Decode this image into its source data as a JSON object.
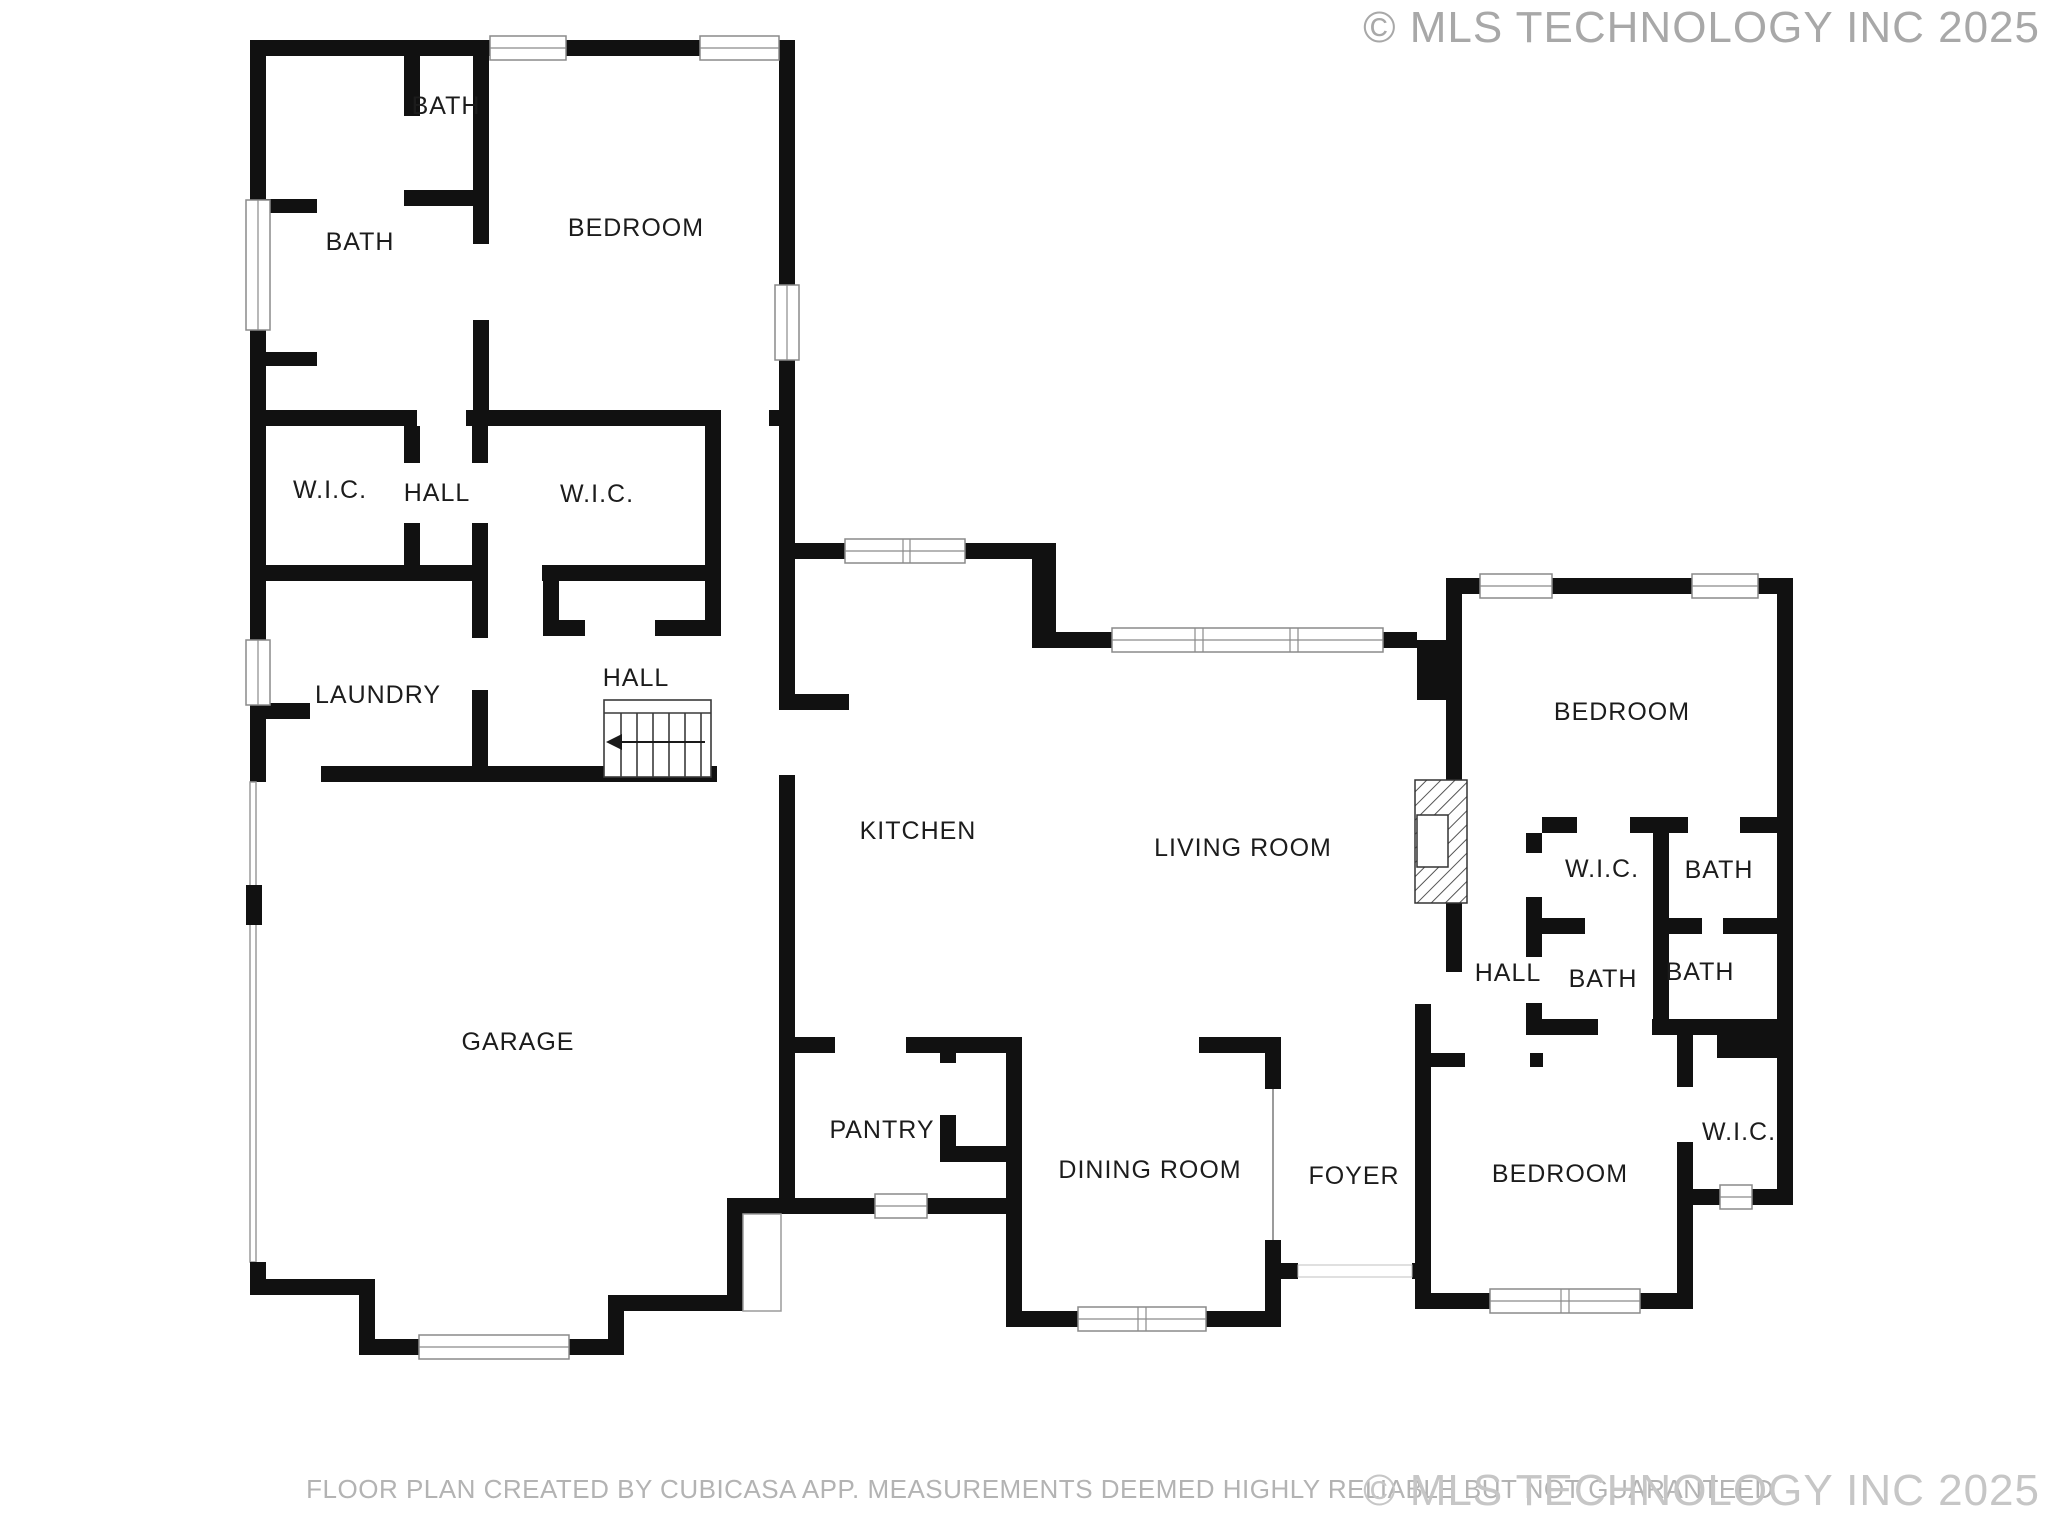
{
  "floor_plan": {
    "disclaimer": "FLOOR PLAN CREATED BY CUBICASA APP. MEASUREMENTS DEEMED HIGHLY RELIABLE BUT NOT GUARANTEED",
    "watermark_top_right": "© MLS TECHNOLOGY INC 2025",
    "watermark_bottom_right": "© MLS TECHNOLOGY INC 2025",
    "rooms": [
      {
        "id": "bath-small-top-left",
        "label": "BATH"
      },
      {
        "id": "bath-large-top-left",
        "label": "BATH"
      },
      {
        "id": "bedroom-top-left",
        "label": "BEDROOM"
      },
      {
        "id": "wic-left",
        "label": "W.I.C."
      },
      {
        "id": "hall-left",
        "label": "HALL"
      },
      {
        "id": "wic-middle",
        "label": "W.I.C."
      },
      {
        "id": "laundry",
        "label": "LAUNDRY"
      },
      {
        "id": "hall-stairs",
        "label": "HALL"
      },
      {
        "id": "garage",
        "label": "GARAGE"
      },
      {
        "id": "kitchen",
        "label": "KITCHEN"
      },
      {
        "id": "living-room",
        "label": "LIVING ROOM"
      },
      {
        "id": "pantry",
        "label": "PANTRY"
      },
      {
        "id": "dining-room",
        "label": "DINING ROOM"
      },
      {
        "id": "foyer",
        "label": "FOYER"
      },
      {
        "id": "bedroom-right",
        "label": "BEDROOM"
      },
      {
        "id": "wic-right-wing",
        "label": "W.I.C."
      },
      {
        "id": "bath-right-top",
        "label": "BATH"
      },
      {
        "id": "hall-right-wing",
        "label": "HALL"
      },
      {
        "id": "bath-right-middle",
        "label": "BATH"
      },
      {
        "id": "bath-right-far",
        "label": "BATH"
      },
      {
        "id": "bedroom-bottom-right",
        "label": "BEDROOM"
      },
      {
        "id": "wic-bottom-right",
        "label": "W.I.C."
      }
    ],
    "colors": {
      "walls": "#111111",
      "window_frame": "#8a8a8a",
      "room_label": "#1c1c1c",
      "watermark_top": "#a8a8a8",
      "watermark_bottom": "#c6c6c6",
      "disclaimer": "#b3b3b3",
      "background": "#ffffff"
    }
  }
}
